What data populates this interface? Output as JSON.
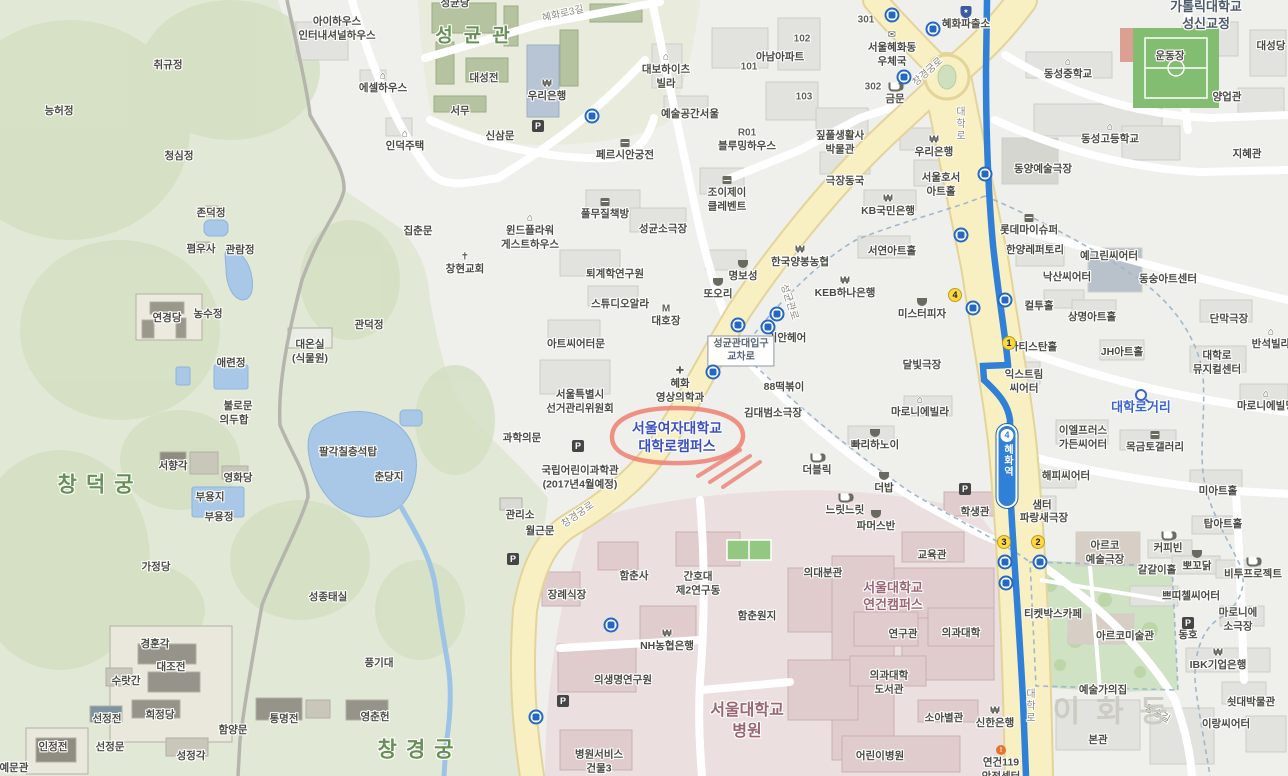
{
  "colors": {
    "urban_bg": "#efefec",
    "park_green": "#e2e8d6",
    "forest_green": "#d2decl",
    "campus_green": "#e9ecdd",
    "hospital_pink": "#ecdfdf",
    "road_yellow": "#f8efc2",
    "subway_blue": "#2f80d6",
    "water_blue": "#a9c8e8",
    "annotation_red": "#ee7f72",
    "univ_blue": "#3c50c0",
    "campus_maroon": "#9a6570",
    "boundary_dash": "#a0b8cc"
  },
  "map": {
    "station": {
      "name": "혜화역",
      "line": "4"
    },
    "intersection": {
      "line1": "성균관대입구",
      "line2": "교차로"
    },
    "annotation": {
      "color": "#ee7f72",
      "target": "서울여자대학교 대학로캠퍼스"
    },
    "glyphs": {
      "parking": "P",
      "won": "₩",
      "house": "⌂",
      "school": "⌂",
      "church": "✝",
      "cross": "✚",
      "mail": "✉",
      "motel": "M",
      "police": "★",
      "fire": "!"
    },
    "labels": [
      {
        "t": "취규정",
        "x": 168,
        "y": 66
      },
      {
        "t": "능허정",
        "x": 59,
        "y": 112
      },
      {
        "t": "청심정",
        "x": 179,
        "y": 157
      },
      {
        "t": "존덕정",
        "x": 211,
        "y": 214
      },
      {
        "t": "폄우사",
        "x": 201,
        "y": 250
      },
      {
        "t": "관람정",
        "x": 240,
        "y": 251
      },
      {
        "t": "연경당",
        "x": 167,
        "y": 319
      },
      {
        "t": "농수정",
        "x": 208,
        "y": 315
      },
      {
        "t": "관덕정",
        "x": 369,
        "y": 326
      },
      {
        "t": "대온실\n(식물원)",
        "x": 310,
        "y": 352
      },
      {
        "t": "애련정",
        "x": 231,
        "y": 364
      },
      {
        "t": "불로문",
        "x": 238,
        "y": 407
      },
      {
        "t": "의두합",
        "x": 234,
        "y": 421
      },
      {
        "t": "서향각",
        "x": 173,
        "y": 467
      },
      {
        "t": "영화당",
        "x": 238,
        "y": 479
      },
      {
        "t": "부용지",
        "x": 210,
        "y": 498
      },
      {
        "t": "부용정",
        "x": 219,
        "y": 518
      },
      {
        "t": "팔각칠층석탑",
        "x": 348,
        "y": 453
      },
      {
        "t": "춘당지",
        "x": 389,
        "y": 478
      },
      {
        "t": "가정당",
        "x": 156,
        "y": 568
      },
      {
        "t": "성종태실",
        "x": 328,
        "y": 598
      },
      {
        "t": "경훈각",
        "x": 155,
        "y": 645
      },
      {
        "t": "대조전",
        "x": 171,
        "y": 668
      },
      {
        "t": "수랏간",
        "x": 126,
        "y": 682
      },
      {
        "t": "풍기대",
        "x": 379,
        "y": 664
      },
      {
        "t": "선정전",
        "x": 107,
        "y": 720
      },
      {
        "t": "희정당",
        "x": 160,
        "y": 716
      },
      {
        "t": "함양문",
        "x": 233,
        "y": 731
      },
      {
        "t": "통명전",
        "x": 284,
        "y": 720
      },
      {
        "t": "영춘헌",
        "x": 375,
        "y": 718
      },
      {
        "t": "인정전",
        "x": 53,
        "y": 748
      },
      {
        "t": "선정문",
        "x": 110,
        "y": 748
      },
      {
        "t": "성정각",
        "x": 191,
        "y": 757
      },
      {
        "t": "예문관",
        "x": 14,
        "y": 769
      },
      {
        "t": "집춘문",
        "x": 418,
        "y": 232
      },
      {
        "t": "관리소",
        "x": 520,
        "y": 516
      },
      {
        "t": "월근문",
        "x": 540,
        "y": 532
      },
      {
        "t": "창덕궁",
        "x": 100,
        "y": 485,
        "c": "area-lg"
      },
      {
        "t": "창경궁",
        "x": 420,
        "y": 750,
        "c": "area-lg"
      },
      {
        "t": "성균관",
        "x": 478,
        "y": 37,
        "c": "area"
      },
      {
        "t": "성균당",
        "x": 455,
        "y": 4
      },
      {
        "t": "아이하우스\n인터내셔널하우스",
        "x": 337,
        "y": 29
      },
      {
        "t": "에셀하우스",
        "x": 383,
        "y": 89,
        "i": "house"
      },
      {
        "t": "인덕주택",
        "x": 405,
        "y": 147,
        "i": "house"
      },
      {
        "t": "대성전",
        "x": 484,
        "y": 79
      },
      {
        "t": "서무",
        "x": 460,
        "y": 112
      },
      {
        "t": "신삼문",
        "x": 500,
        "y": 137
      },
      {
        "t": "우리은행",
        "x": 547,
        "y": 97,
        "i": "won"
      },
      {
        "t": "페르시안궁전",
        "x": 625,
        "y": 156,
        "i": "shop"
      },
      {
        "t": "윈드플라워\n게스트하우스",
        "x": 530,
        "y": 238,
        "i": "house"
      },
      {
        "t": "창현교회",
        "x": 465,
        "y": 270,
        "i": "church"
      },
      {
        "t": "대보하이츠\n빌라",
        "x": 666,
        "y": 77,
        "i": "house"
      },
      {
        "t": "예술공간서울",
        "x": 690,
        "y": 115
      },
      {
        "t": "아남아파트",
        "x": 780,
        "y": 58
      },
      {
        "t": "101",
        "x": 749,
        "y": 67,
        "c": "num"
      },
      {
        "t": "102",
        "x": 802,
        "y": 39,
        "c": "num"
      },
      {
        "t": "103",
        "x": 804,
        "y": 97,
        "c": "num"
      },
      {
        "t": "301",
        "x": 866,
        "y": 20,
        "c": "num"
      },
      {
        "t": "302",
        "x": 873,
        "y": 87,
        "c": "num"
      },
      {
        "t": "R01",
        "x": 747,
        "y": 133,
        "c": "num"
      },
      {
        "t": "블루밍하우스",
        "x": 747,
        "y": 147
      },
      {
        "t": "짚풀생활사\n박물관",
        "x": 840,
        "y": 143
      },
      {
        "t": "조이제이\n클레벤트",
        "x": 727,
        "y": 200,
        "i": "shop"
      },
      {
        "t": "풀무질책방",
        "x": 605,
        "y": 215,
        "i": "shop"
      },
      {
        "t": "성균소극장",
        "x": 663,
        "y": 230
      },
      {
        "t": "퇴계학연구원",
        "x": 615,
        "y": 275
      },
      {
        "t": "극장동국",
        "x": 845,
        "y": 182
      },
      {
        "t": "KB국민은행",
        "x": 888,
        "y": 212,
        "i": "won"
      },
      {
        "t": "명보성",
        "x": 743,
        "y": 277,
        "i": "bowl"
      },
      {
        "t": "또오리",
        "x": 718,
        "y": 295,
        "i": "bowl"
      },
      {
        "t": "한국양봉농협",
        "x": 800,
        "y": 263,
        "i": "won"
      },
      {
        "t": "KEB하나은행",
        "x": 845,
        "y": 294,
        "i": "won"
      },
      {
        "t": "스튜디오알라",
        "x": 620,
        "y": 305
      },
      {
        "t": "대호장",
        "x": 666,
        "y": 322,
        "i": "motel"
      },
      {
        "t": "아트씨어터문",
        "x": 576,
        "y": 345
      },
      {
        "t": "리안헤어",
        "x": 787,
        "y": 339
      },
      {
        "t": "혜화\n영상의학과",
        "x": 680,
        "y": 391,
        "i": "cross"
      },
      {
        "t": "88떡볶이",
        "x": 784,
        "y": 388
      },
      {
        "t": "김대범소극장",
        "x": 773,
        "y": 414
      },
      {
        "t": "서울특별시\n선거관리위원회",
        "x": 580,
        "y": 402
      },
      {
        "t": "과학의문",
        "x": 522,
        "y": 439
      },
      {
        "t": "국립어린이과학관\n(2017년4월예정)",
        "x": 580,
        "y": 478
      },
      {
        "t": "서울여자대학교\n대학로캠퍼스",
        "x": 677,
        "y": 437,
        "c": "uni-blue"
      },
      {
        "t": "혜화파출소",
        "x": 966,
        "y": 25,
        "i": "police"
      },
      {
        "t": "서울혜화동\n우체국",
        "x": 892,
        "y": 55,
        "i": "mail"
      },
      {
        "t": "금문",
        "x": 895,
        "y": 100,
        "i": "cup"
      },
      {
        "t": "우리은행",
        "x": 934,
        "y": 153,
        "i": "won"
      },
      {
        "t": "서울호서\n아트홀",
        "x": 941,
        "y": 185
      },
      {
        "t": "동양예술극장",
        "x": 1043,
        "y": 170
      },
      {
        "t": "동성중학교",
        "x": 1068,
        "y": 75,
        "i": "school"
      },
      {
        "t": "동성고등학교",
        "x": 1110,
        "y": 140,
        "i": "school"
      },
      {
        "t": "운동장",
        "x": 1170,
        "y": 57
      },
      {
        "t": "가톨릭대학교\n성신교정",
        "x": 1206,
        "y": 16,
        "c": "campus-navy"
      },
      {
        "t": "대성당",
        "x": 1271,
        "y": 47
      },
      {
        "t": "양업관",
        "x": 1227,
        "y": 98
      },
      {
        "t": "지혜관",
        "x": 1247,
        "y": 155
      },
      {
        "t": "서연아트홀",
        "x": 892,
        "y": 252
      },
      {
        "t": "미스터피자",
        "x": 922,
        "y": 315,
        "i": "bowl"
      },
      {
        "t": "롯데마이슈퍼",
        "x": 1029,
        "y": 231,
        "i": "shop"
      },
      {
        "t": "한양레퍼토리",
        "x": 1035,
        "y": 251
      },
      {
        "t": "예그린씨어터",
        "x": 1109,
        "y": 257
      },
      {
        "t": "낙산씨어터",
        "x": 1067,
        "y": 278
      },
      {
        "t": "동숭아트센터",
        "x": 1168,
        "y": 280
      },
      {
        "t": "컬투홀",
        "x": 1039,
        "y": 307
      },
      {
        "t": "상명아트홀",
        "x": 1092,
        "y": 318
      },
      {
        "t": "단막극장",
        "x": 1229,
        "y": 320
      },
      {
        "t": "반석빌라",
        "x": 1271,
        "y": 345,
        "i": "house"
      },
      {
        "t": "아티스탄홀",
        "x": 1033,
        "y": 348
      },
      {
        "t": "JH아트홀",
        "x": 1122,
        "y": 353
      },
      {
        "t": "대학로\n뮤지컬센터",
        "x": 1217,
        "y": 363
      },
      {
        "t": "달빛극장",
        "x": 922,
        "y": 366
      },
      {
        "t": "익스트림\n씨어터",
        "x": 1024,
        "y": 382
      },
      {
        "t": "마로니에빌라",
        "x": 920,
        "y": 413,
        "i": "house"
      },
      {
        "t": "대학로거리",
        "x": 1141,
        "y": 408,
        "c": "blue-search",
        "i": "magnifier"
      },
      {
        "t": "이엘프러스\n가든씨어터",
        "x": 1083,
        "y": 438
      },
      {
        "t": "목금토갤러리",
        "x": 1155,
        "y": 448,
        "i": "shop"
      },
      {
        "t": "마로니에빌딩",
        "x": 1266,
        "y": 407,
        "i": "house"
      },
      {
        "t": "빠리하노이",
        "x": 875,
        "y": 446,
        "i": "bowl"
      },
      {
        "t": "더블릭",
        "x": 817,
        "y": 471,
        "i": "cup"
      },
      {
        "t": "더밥",
        "x": 884,
        "y": 489,
        "i": "bowl"
      },
      {
        "t": "느릿느릿",
        "x": 845,
        "y": 511,
        "i": "cup"
      },
      {
        "t": "파머스반",
        "x": 876,
        "y": 527,
        "i": "bowl"
      },
      {
        "t": "해피씨어터",
        "x": 1066,
        "y": 477
      },
      {
        "t": "미아트홀",
        "x": 1218,
        "y": 492
      },
      {
        "t": "샘터",
        "x": 1042,
        "y": 506
      },
      {
        "t": "파랑새극장",
        "x": 1044,
        "y": 519
      },
      {
        "t": "탑아트홀",
        "x": 1223,
        "y": 525
      },
      {
        "t": "아르코\n예술극장",
        "x": 1105,
        "y": 553
      },
      {
        "t": "커피빈",
        "x": 1168,
        "y": 549,
        "i": "cup"
      },
      {
        "t": "뽀꼬닭",
        "x": 1197,
        "y": 567,
        "i": "bowl"
      },
      {
        "t": "비투프로젝트",
        "x": 1253,
        "y": 575,
        "i": "cup"
      },
      {
        "t": "갈갈이홀",
        "x": 1157,
        "y": 571
      },
      {
        "t": "쁘띠첼씨어터",
        "x": 1191,
        "y": 597
      },
      {
        "t": "마로니에\n소극장",
        "x": 1238,
        "y": 620
      },
      {
        "t": "티켓박스카페",
        "x": 1053,
        "y": 615
      },
      {
        "t": "아르코미술관",
        "x": 1125,
        "y": 637
      },
      {
        "t": "동호",
        "x": 1188,
        "y": 636
      },
      {
        "t": "IBK기업은행",
        "x": 1218,
        "y": 666,
        "i": "won"
      },
      {
        "t": "예술가의집",
        "x": 1103,
        "y": 691
      },
      {
        "t": "쇳대박물관",
        "x": 1251,
        "y": 703
      },
      {
        "t": "이랑씨어터",
        "x": 1226,
        "y": 725
      },
      {
        "t": "본관",
        "x": 1098,
        "y": 741
      },
      {
        "t": "이화동",
        "x": 1118,
        "y": 712,
        "c": "district"
      },
      {
        "t": "함춘사",
        "x": 634,
        "y": 577
      },
      {
        "t": "간호대\n제2연구동",
        "x": 698,
        "y": 584
      },
      {
        "t": "함춘원지",
        "x": 757,
        "y": 617
      },
      {
        "t": "장례식장",
        "x": 567,
        "y": 596
      },
      {
        "t": "의대분관",
        "x": 823,
        "y": 574
      },
      {
        "t": "NH농협은행",
        "x": 667,
        "y": 647,
        "i": "won"
      },
      {
        "t": "의생명연구원",
        "x": 623,
        "y": 681
      },
      {
        "t": "서울대학교\n연건캠퍼스",
        "x": 893,
        "y": 597,
        "c": "campus-maroon"
      },
      {
        "t": "교육관",
        "x": 932,
        "y": 556
      },
      {
        "t": "학생관",
        "x": 975,
        "y": 513
      },
      {
        "t": "연구관",
        "x": 903,
        "y": 635
      },
      {
        "t": "의과대학",
        "x": 961,
        "y": 634
      },
      {
        "t": "의과대학\n도서관",
        "x": 889,
        "y": 683
      },
      {
        "t": "소아별관",
        "x": 944,
        "y": 719
      },
      {
        "t": "신한은행",
        "x": 995,
        "y": 724,
        "i": "won"
      },
      {
        "t": "어린이병원",
        "x": 880,
        "y": 757
      },
      {
        "t": "연건119\n안전센터",
        "x": 1001,
        "y": 770,
        "i": "fire"
      },
      {
        "t": "서울대학교\n병원",
        "x": 747,
        "y": 722,
        "c": "campus-maroon-lg"
      },
      {
        "t": "병원서비스\n건물3",
        "x": 599,
        "y": 762
      },
      {
        "t": "창경궁로",
        "x": 928,
        "y": 72,
        "c": "road",
        "r": -42
      },
      {
        "t": "혜화로3길",
        "x": 563,
        "y": 14,
        "c": "road",
        "r": -13
      },
      {
        "t": "성균관로",
        "x": 789,
        "y": 302,
        "c": "road",
        "r": 72
      },
      {
        "t": "창경궁로",
        "x": 578,
        "y": 515,
        "c": "road",
        "r": -35
      },
      {
        "t": "대학로",
        "x": 959,
        "y": 124,
        "c": "vroad"
      },
      {
        "t": "대학로",
        "x": 1029,
        "y": 706,
        "c": "vroad"
      },
      {
        "t": "동숭길",
        "x": 1157,
        "y": 714,
        "c": "road",
        "r": 28
      }
    ],
    "bus_stops": [
      [
        592,
        116
      ],
      [
        892,
        15
      ],
      [
        933,
        29
      ],
      [
        904,
        77
      ],
      [
        985,
        174
      ],
      [
        961,
        235
      ],
      [
        973,
        308
      ],
      [
        1005,
        300
      ],
      [
        777,
        314
      ],
      [
        768,
        327
      ],
      [
        738,
        325
      ],
      [
        713,
        372
      ],
      [
        611,
        625
      ],
      [
        536,
        717
      ],
      [
        1005,
        562
      ],
      [
        1040,
        562
      ],
      [
        1006,
        583
      ]
    ],
    "parking": [
      [
        538,
        126
      ],
      [
        578,
        446
      ],
      [
        513,
        559
      ],
      [
        563,
        701
      ],
      [
        965,
        489
      ],
      [
        1188,
        623
      ]
    ],
    "exits": [
      {
        "n": "4",
        "x": 955,
        "y": 295
      },
      {
        "n": "1",
        "x": 1009,
        "y": 343
      },
      {
        "n": "3",
        "x": 1004,
        "y": 542
      },
      {
        "n": "2",
        "x": 1038,
        "y": 542
      }
    ]
  }
}
